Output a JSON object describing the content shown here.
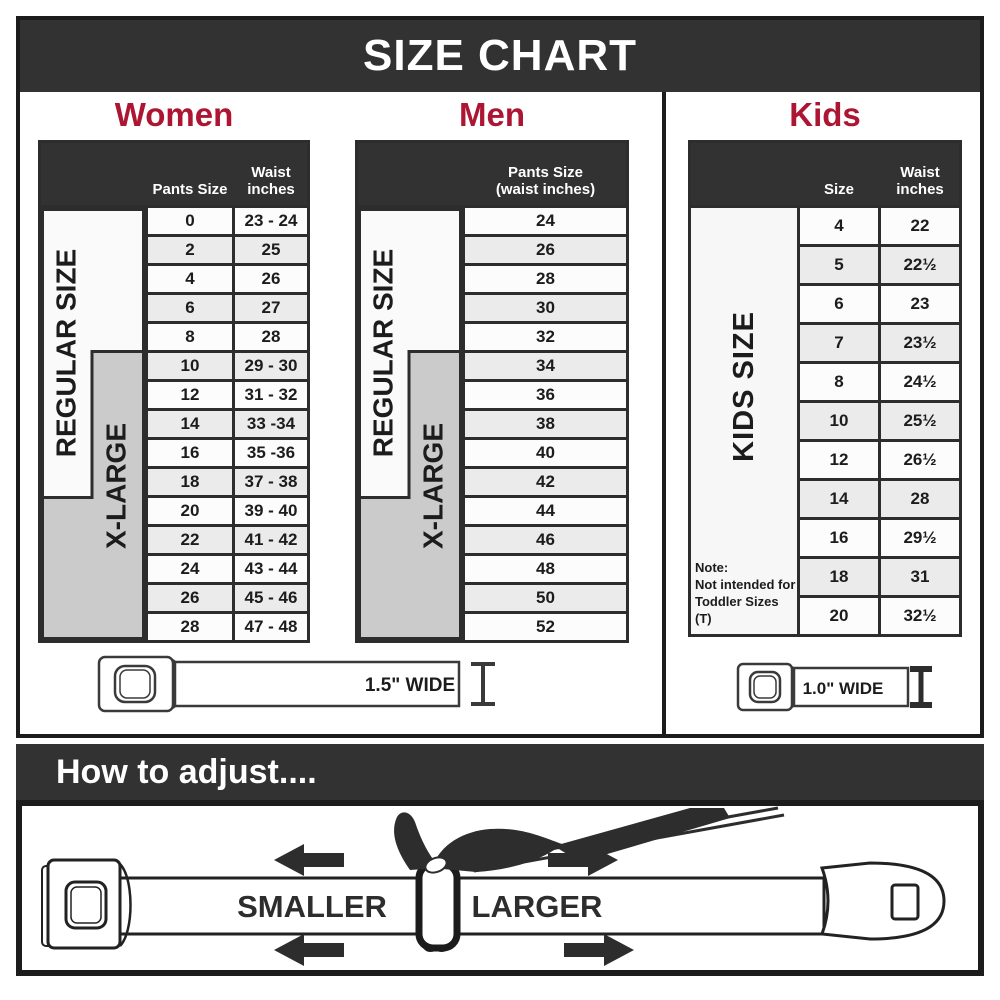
{
  "title": "SIZE CHART",
  "colors": {
    "accent_red": "#AC1632",
    "header_dark": "#323232",
    "xlarge_gray": "#CBCBCB",
    "row_shade": "#EBEBEB"
  },
  "women": {
    "heading": "Women",
    "col_pants": "Pants Size",
    "col_waist": "Waist inches",
    "regular_label": "REGULAR SIZE",
    "xlarge_label": "X-LARGE",
    "rows": [
      {
        "size": "0",
        "waist": "23 - 24"
      },
      {
        "size": "2",
        "waist": "25"
      },
      {
        "size": "4",
        "waist": "26"
      },
      {
        "size": "6",
        "waist": "27"
      },
      {
        "size": "8",
        "waist": "28"
      },
      {
        "size": "10",
        "waist": "29 - 30"
      },
      {
        "size": "12",
        "waist": "31 - 32"
      },
      {
        "size": "14",
        "waist": "33 -34"
      },
      {
        "size": "16",
        "waist": "35 -36"
      },
      {
        "size": "18",
        "waist": "37 - 38"
      },
      {
        "size": "20",
        "waist": "39 - 40"
      },
      {
        "size": "22",
        "waist": "41 - 42"
      },
      {
        "size": "24",
        "waist": "43 - 44"
      },
      {
        "size": "26",
        "waist": "45 - 46"
      },
      {
        "size": "28",
        "waist": "47 - 48"
      }
    ]
  },
  "men": {
    "heading": "Men",
    "col_pants": "Pants Size (waist inches)",
    "regular_label": "REGULAR SIZE",
    "xlarge_label": "X-LARGE",
    "rows": [
      {
        "size": "24"
      },
      {
        "size": "26"
      },
      {
        "size": "28"
      },
      {
        "size": "30"
      },
      {
        "size": "32"
      },
      {
        "size": "34"
      },
      {
        "size": "36"
      },
      {
        "size": "38"
      },
      {
        "size": "40"
      },
      {
        "size": "42"
      },
      {
        "size": "44"
      },
      {
        "size": "46"
      },
      {
        "size": "48"
      },
      {
        "size": "50"
      },
      {
        "size": "52"
      }
    ]
  },
  "kids": {
    "heading": "Kids",
    "col_size": "Size",
    "col_waist": "Waist inches",
    "side_label": "KIDS SIZE",
    "note_title": "Note:",
    "note_line1": "Not intended for",
    "note_line2": "Toddler Sizes (T)",
    "rows": [
      {
        "size": "4",
        "waist": "22"
      },
      {
        "size": "5",
        "waist": "22½"
      },
      {
        "size": "6",
        "waist": "23"
      },
      {
        "size": "7",
        "waist": "23½"
      },
      {
        "size": "8",
        "waist": "24½"
      },
      {
        "size": "10",
        "waist": "25½"
      },
      {
        "size": "12",
        "waist": "26½"
      },
      {
        "size": "14",
        "waist": "28"
      },
      {
        "size": "16",
        "waist": "29½"
      },
      {
        "size": "18",
        "waist": "31"
      },
      {
        "size": "20",
        "waist": "32½"
      }
    ]
  },
  "belts": {
    "adult_width_label": "1.5\" WIDE",
    "kids_width_label": "1.0\" WIDE"
  },
  "how_to": {
    "heading": "How to adjust....",
    "smaller_label": "SMALLER",
    "larger_label": "LARGER"
  }
}
